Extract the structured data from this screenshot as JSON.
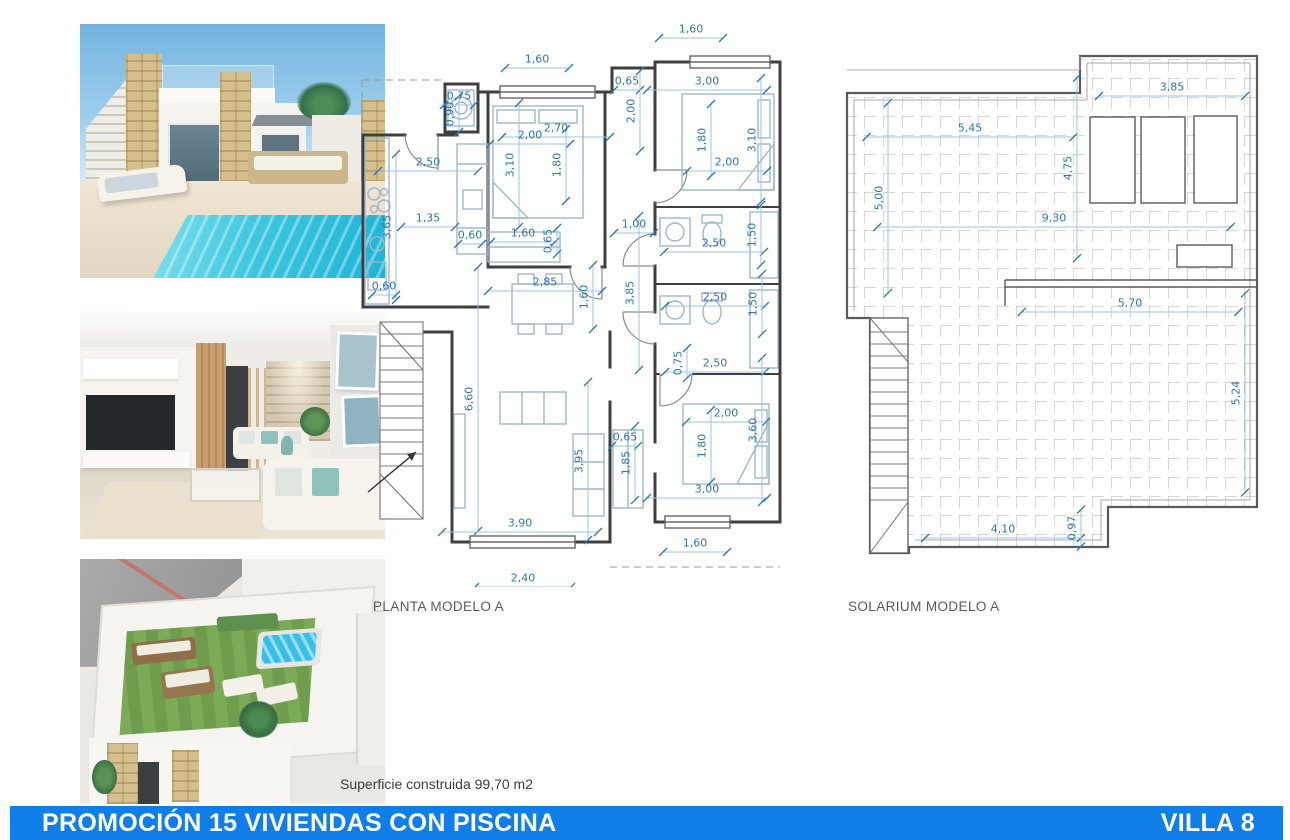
{
  "photos": [
    {
      "alt": "villa exterior with private pool"
    },
    {
      "alt": "living room interior render"
    },
    {
      "alt": "aerial view of rooftop solarium with jacuzzi"
    }
  ],
  "plans": {
    "planta": {
      "label": "PLANTA MODELO A",
      "scale_px_per_m": 40,
      "dims": [
        {
          "v": "1,60",
          "x": 177,
          "y": 37,
          "o": "h"
        },
        {
          "v": "1,60",
          "x": 331,
          "y": 7,
          "o": "h"
        },
        {
          "v": "0,75",
          "x": 99,
          "y": 74,
          "o": "h"
        },
        {
          "v": "0,90",
          "x": 90,
          "y": 92,
          "o": "v"
        },
        {
          "v": "2,70",
          "x": 196,
          "y": 106,
          "o": "h"
        },
        {
          "v": "0,65",
          "x": 267,
          "y": 59,
          "o": "h"
        },
        {
          "v": "2,00",
          "x": 271,
          "y": 89,
          "o": "v"
        },
        {
          "v": "3,00",
          "x": 347,
          "y": 59,
          "o": "h"
        },
        {
          "v": "2,00",
          "x": 170,
          "y": 113,
          "o": "h"
        },
        {
          "v": "3,10",
          "x": 150,
          "y": 143,
          "o": "v"
        },
        {
          "v": "1,80",
          "x": 197,
          "y": 143,
          "o": "v"
        },
        {
          "v": "1,80",
          "x": 342,
          "y": 118,
          "o": "v"
        },
        {
          "v": "3,10",
          "x": 392,
          "y": 118,
          "o": "v"
        },
        {
          "v": "2,00",
          "x": 367,
          "y": 140,
          "o": "h"
        },
        {
          "v": "2,50",
          "x": 68,
          "y": 140,
          "o": "h"
        },
        {
          "v": "1,35",
          "x": 68,
          "y": 196,
          "o": "h"
        },
        {
          "v": "3,65",
          "x": 27,
          "y": 205,
          "o": "v"
        },
        {
          "v": "0,60",
          "x": 110,
          "y": 213,
          "o": "h"
        },
        {
          "v": "1,60",
          "x": 163,
          "y": 211,
          "o": "h"
        },
        {
          "v": "0,65",
          "x": 188,
          "y": 219,
          "o": "v"
        },
        {
          "v": "1,00",
          "x": 274,
          "y": 202,
          "o": "h"
        },
        {
          "v": "2,50",
          "x": 354,
          "y": 221,
          "o": "h"
        },
        {
          "v": "1,50",
          "x": 392,
          "y": 213,
          "o": "v"
        },
        {
          "v": "0,60",
          "x": 24,
          "y": 264,
          "o": "h"
        },
        {
          "v": "2,85",
          "x": 185,
          "y": 260,
          "o": "h"
        },
        {
          "v": "1,60",
          "x": 224,
          "y": 275,
          "o": "v"
        },
        {
          "v": "3,85",
          "x": 270,
          "y": 271,
          "o": "v"
        },
        {
          "v": "2,50",
          "x": 355,
          "y": 275,
          "o": "h"
        },
        {
          "v": "1,50",
          "x": 393,
          "y": 282,
          "o": "v"
        },
        {
          "v": "0,75",
          "x": 318,
          "y": 341,
          "o": "v"
        },
        {
          "v": "2,50",
          "x": 355,
          "y": 341,
          "o": "h"
        },
        {
          "v": "6,60",
          "x": 109,
          "y": 377,
          "o": "v"
        },
        {
          "v": "3,95",
          "x": 219,
          "y": 439,
          "o": "v"
        },
        {
          "v": "0,65",
          "x": 265,
          "y": 415,
          "o": "h"
        },
        {
          "v": "1,85",
          "x": 266,
          "y": 441,
          "o": "v"
        },
        {
          "v": "1,80",
          "x": 342,
          "y": 424,
          "o": "v"
        },
        {
          "v": "2,00",
          "x": 366,
          "y": 391,
          "o": "h"
        },
        {
          "v": "3,60",
          "x": 393,
          "y": 408,
          "o": "v"
        },
        {
          "v": "3,00",
          "x": 347,
          "y": 467,
          "o": "h"
        },
        {
          "v": "3,90",
          "x": 160,
          "y": 501,
          "o": "h"
        },
        {
          "v": "1,60",
          "x": 335,
          "y": 521,
          "o": "h"
        },
        {
          "v": "2,40",
          "x": 163,
          "y": 556,
          "o": "h"
        }
      ]
    },
    "solarium": {
      "label": "SOLARIUM MODELO A",
      "scale_px_per_m": 38,
      "dims": [
        {
          "v": "3,85",
          "x": 327,
          "y": 47,
          "o": "h"
        },
        {
          "v": "5,45",
          "x": 125,
          "y": 88,
          "o": "h"
        },
        {
          "v": "5,00",
          "x": 34,
          "y": 158,
          "o": "v"
        },
        {
          "v": "4,75",
          "x": 223,
          "y": 128,
          "o": "v"
        },
        {
          "v": "9,30",
          "x": 209,
          "y": 178,
          "o": "h"
        },
        {
          "v": "5,70",
          "x": 285,
          "y": 263,
          "o": "h"
        },
        {
          "v": "5,24",
          "x": 391,
          "y": 353,
          "o": "v"
        },
        {
          "v": "4,10",
          "x": 158,
          "y": 489,
          "o": "h"
        },
        {
          "v": "0,97",
          "x": 227,
          "y": 488,
          "o": "v"
        }
      ]
    }
  },
  "area_note": "Superficie construida 99,70 m2",
  "footer": {
    "title": "PROMOCIÓN 15 VIVIENDAS CON PISCINA",
    "villa": "VILLA 8",
    "bar_color": "#107EE9"
  },
  "colors": {
    "dim_text": "#2E75B6",
    "dim_line": "#9DC3E6",
    "wall": "#3F3F3F",
    "furniture": "#9FB6C9",
    "caption_text": "#595959"
  }
}
